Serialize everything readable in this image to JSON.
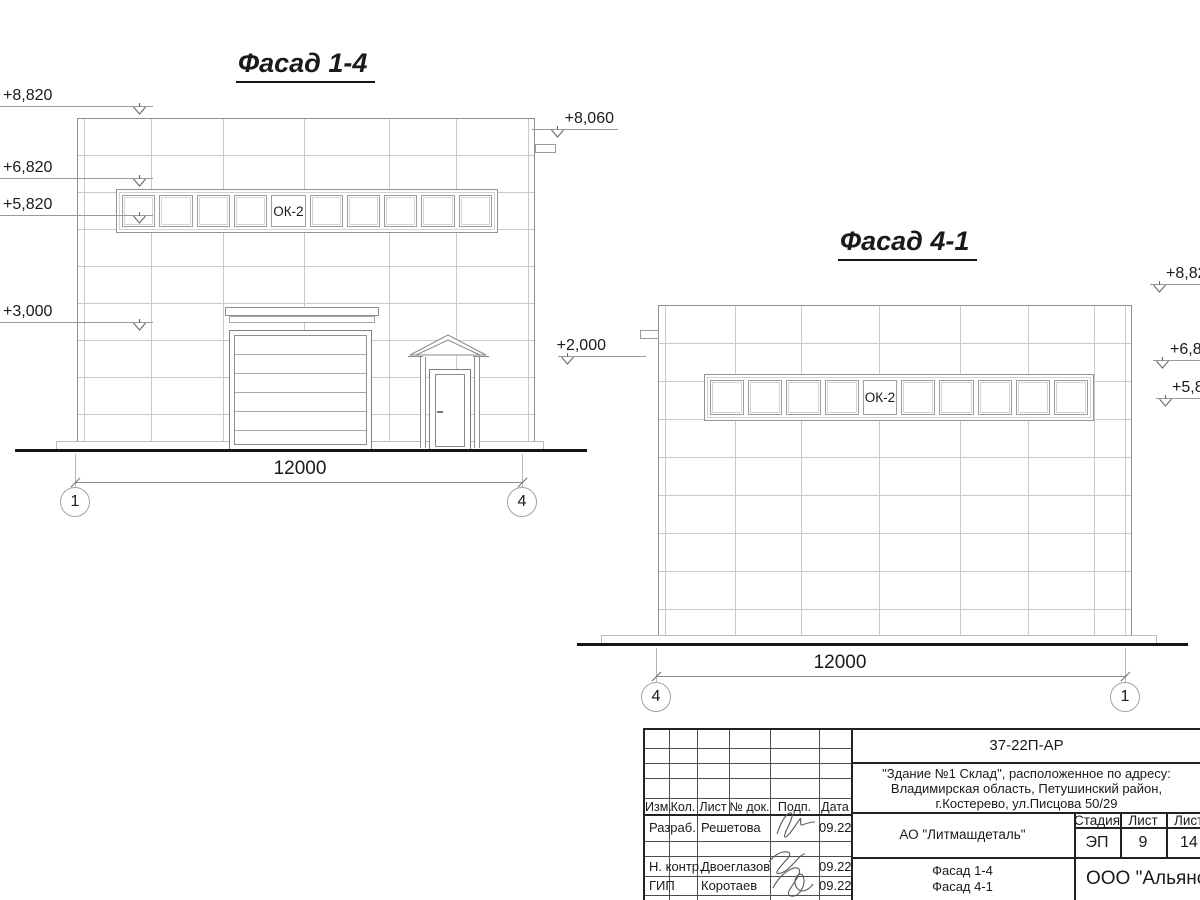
{
  "facade_14": {
    "title": "Фасад 1-4",
    "window_label": "ОК-2",
    "dimension": "12000",
    "axis_start": "1",
    "axis_end": "4",
    "elevations_left": [
      {
        "label": "+8,820"
      },
      {
        "label": "+6,820"
      },
      {
        "label": "+5,820"
      },
      {
        "label": "+3,000"
      }
    ],
    "elevations_right": [
      {
        "label": "+8,060"
      },
      {
        "label": "+2,000"
      }
    ]
  },
  "facade_41": {
    "title": "Фасад 4-1",
    "window_label": "ОК-2",
    "dimension": "12000",
    "axis_start": "4",
    "axis_end": "1",
    "elevations_right": [
      {
        "label": "+8,820"
      },
      {
        "label": "+6,820"
      },
      {
        "label": "+5,820"
      }
    ]
  },
  "title_block": {
    "doc_code": "37-22П-АР",
    "project_line1": "\"Здание №1 Склад\", расположенное по адресу:",
    "project_line2": "Владимирская область, Петушинский район,",
    "project_line3": "г.Костерево, ул.Писцова 50/29",
    "client": "АО \"Литмашдеталь\"",
    "sheet_name_line1": "Фасад 1-4",
    "sheet_name_line2": "Фасад 4-1",
    "company": "ООО \"Альянс\"",
    "stage_header": "Стадия",
    "sheet_header": "Лист",
    "sheets_header": "Листов",
    "stage": "ЭП",
    "sheet_number": "9",
    "sheets_total": "14",
    "columns": [
      "Изм.",
      "Кол.",
      "Лист",
      "№ док.",
      "Подп.",
      "Дата"
    ],
    "signature_rows": [
      {
        "role": "Разраб.",
        "name": "Решетова",
        "date": "09.22"
      },
      {
        "role": "Н. контр.",
        "name": "Двоеглазов",
        "date": "09.22"
      },
      {
        "role": "ГИП",
        "name": "Коротаев",
        "date": "09.22"
      }
    ]
  }
}
